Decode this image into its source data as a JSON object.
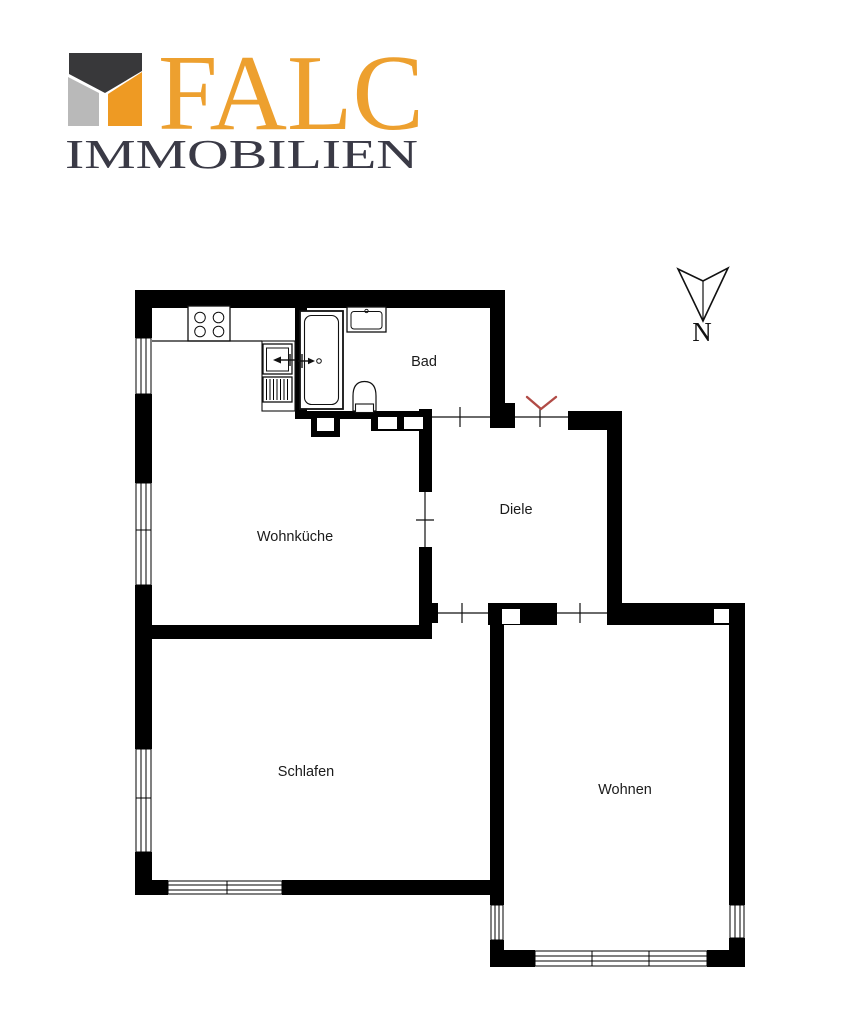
{
  "brand": {
    "name": "FALC",
    "subtitle": "IMMOBILIEN",
    "logo_colors": {
      "dark": "#38383A",
      "gray": "#B9B9B9",
      "orange": "#EE9A23",
      "wordmark": "#EDA02F",
      "subtitle_color": "#3A3A46"
    }
  },
  "compass": {
    "label": "N"
  },
  "plan": {
    "wall_color": "#000000",
    "entrance": {
      "marker_color": "#B14B46"
    },
    "rooms": [
      {
        "id": "bad",
        "label": "Bad"
      },
      {
        "id": "wohnkueche",
        "label": "Wohnküche"
      },
      {
        "id": "diele",
        "label": "Diele"
      },
      {
        "id": "schlafen",
        "label": "Schlafen"
      },
      {
        "id": "wohnen",
        "label": "Wohnen"
      }
    ],
    "fixtures": [
      "stove",
      "kitchen-sink",
      "drainer",
      "bathtub",
      "washbasin",
      "toilet"
    ],
    "openings": [
      "bathroom-door",
      "entrance-door",
      "kitchen-hall-door",
      "hall-bedroom-door",
      "hall-living-door"
    ]
  }
}
